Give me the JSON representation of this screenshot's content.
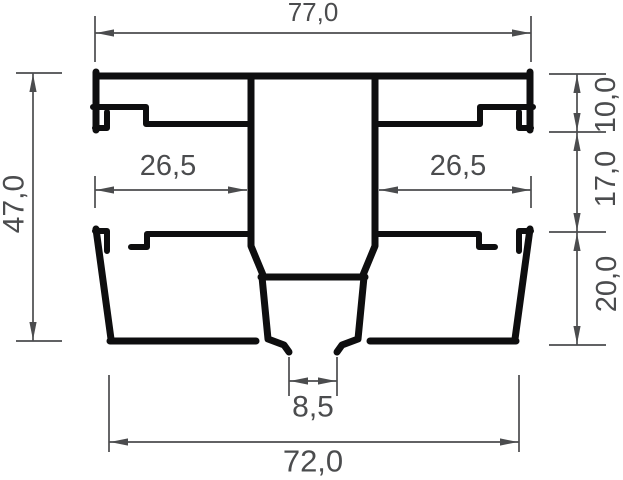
{
  "drawing": {
    "dimensions": {
      "top_width": "77,0",
      "overall_height": "47,0",
      "left_chamber_width": "26,5",
      "right_chamber_width": "26,5",
      "top_section_height": "10,0",
      "middle_section_height": "17,0",
      "bottom_section_height": "20,0",
      "bottom_gap_width": "8,5",
      "bottom_width": "72,0"
    },
    "colors": {
      "profile": "#0e0e0f",
      "dimension": "#4b4c4e",
      "background": "#ffffff"
    }
  }
}
